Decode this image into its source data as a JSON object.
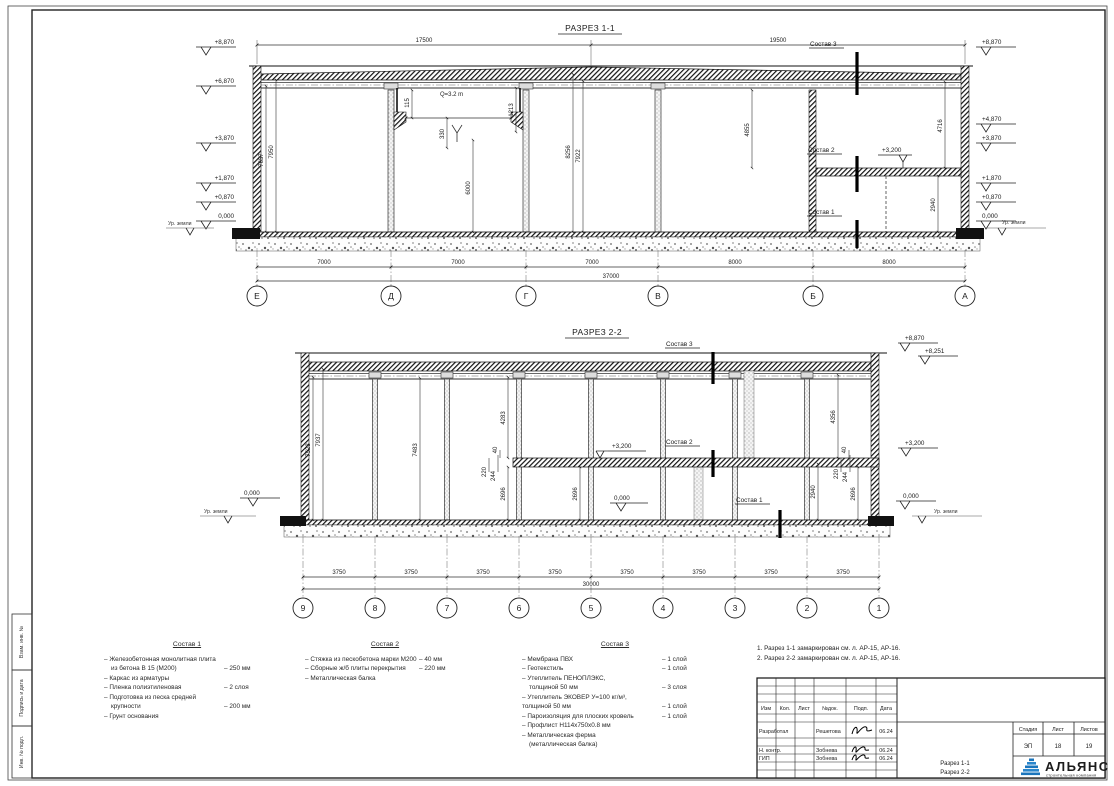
{
  "frame": {
    "labels": [
      "Взам. инв. №",
      "Подпись и дата",
      "Инв. № подл."
    ]
  },
  "s1": {
    "title": "РАЗРЕЗ 1-1",
    "dim_top_left": "17500",
    "dim_top_right": "19500",
    "elev_left": [
      "+8,870",
      "+6,870",
      "+3,870",
      "+1,870",
      "+0,870",
      "0,000"
    ],
    "elev_right": [
      "+8,870",
      "+4,870",
      "+3,870",
      "+1,870",
      "+0,870",
      "0,000"
    ],
    "ground_left": "Ур. земли",
    "ground_right": "Ур. земли",
    "crane": "Q=3.2 m",
    "v115": "115",
    "v1213": "1213",
    "v330": "330",
    "v6000": "6000",
    "v7657": "7657",
    "v7950": "7950",
    "v8256": "8256",
    "v7922": "7922",
    "v4855": "4855",
    "v4716": "4716",
    "v2940": "2940",
    "mezz_elev": "+3,200",
    "sostav1": "Состав 1",
    "sostav2": "Состав 2",
    "sostav3": "Состав 3",
    "dims": [
      "7000",
      "7000",
      "7000",
      "8000",
      "8000"
    ],
    "total": "37000",
    "axes": [
      "Е",
      "Д",
      "Г",
      "В",
      "Б",
      "А"
    ]
  },
  "s2": {
    "title": "РАЗРЕЗ 2-2",
    "elev_top": "+8,870",
    "elev_top2": "+8,251",
    "elev_mezz_in": "+3,200",
    "elev_mezz_out": "+3,200",
    "zero_left": "0,000",
    "zero_in": "0,000",
    "zero_right": "0,000",
    "ground_left": "Ур. земли",
    "ground_right": "Ур. земли",
    "v7523": "7523",
    "v7937": "7937",
    "v7483": "7483",
    "v4283": "4283",
    "v40l": "40",
    "v220l": "220",
    "v244l": "244",
    "v2696a": "2696",
    "v2696b": "2696",
    "v4356": "4356",
    "v40r": "40",
    "v220r": "220",
    "v244r": "244",
    "v2940": "2940",
    "v2696r": "2696",
    "sostav1": "Состав 1",
    "sostav2": "Состав 2",
    "sostav3": "Состав 3",
    "dims": [
      "3750",
      "3750",
      "3750",
      "3750",
      "3750",
      "3750",
      "3750",
      "3750"
    ],
    "total": "30000",
    "axes": [
      "9",
      "8",
      "7",
      "6",
      "5",
      "4",
      "3",
      "2",
      "1"
    ]
  },
  "comp1": {
    "title": "Состав 1",
    "rows": [
      {
        "t": "– Железобетонная  монолитная плита",
        "v": ""
      },
      {
        "t": "из бетона В 15 (М200)",
        "v": "– 250 мм"
      },
      {
        "t": "– Каркас из арматуры",
        "v": ""
      },
      {
        "t": "– Пленка полиэтиленовая",
        "v": "– 2 слоя"
      },
      {
        "t": "– Подготовка из песка средней",
        "v": ""
      },
      {
        "t": "крупности",
        "v": "– 200 мм"
      },
      {
        "t": "– Грунт основания",
        "v": ""
      }
    ]
  },
  "comp2": {
    "title": "Состав 2",
    "rows": [
      {
        "t": "– Стяжка из пескобетона марки М200",
        "v": "– 40 мм"
      },
      {
        "t": "– Сборные ж/б плиты перекрытия",
        "v": "– 220 мм"
      },
      {
        "t": "– Металлическая балка",
        "v": ""
      }
    ]
  },
  "comp3": {
    "title": "Состав 3",
    "rows": [
      {
        "t": "– Мембрана ПВХ",
        "v": "– 1 слой"
      },
      {
        "t": "– Геотекстиль",
        "v": "– 1 слой"
      },
      {
        "t": "– Утеплитель ПЕНОПЛЭКС,",
        "v": ""
      },
      {
        "t": "толщиной 50 мм",
        "v": "– 3 слоя"
      },
      {
        "t": "– Утеплитель ЭКОВЕР У=100 кг/м³,",
        "v": ""
      },
      {
        "t": "толщиной 50 мм",
        "v": "– 1 слой"
      },
      {
        "t": "– Пароизоляция для плоских кровель",
        "v": "– 1 слой"
      },
      {
        "t": "– Профлист  Н114х750х0.8 мм",
        "v": ""
      },
      {
        "t": "– Металлическая ферма",
        "v": ""
      },
      {
        "t": "(металлическая балка)",
        "v": ""
      }
    ]
  },
  "notes": [
    "1. Разрез 1-1 замаркирован см. л. АР-15, АР-16.",
    "2. Разрез 2-2 замаркирован см. л. АР-15, АР-16."
  ],
  "tb": {
    "cols": [
      "Изм",
      "Кол.",
      "Лист",
      "№док.",
      "Подп.",
      "Дата"
    ],
    "r1_role": "Разработал",
    "r1_name": "Решетова",
    "r1_date": "06.24",
    "r2_role": "Н. контр.",
    "r2_name": "Зобнева",
    "r2_date": "06.24",
    "r3_role": "ГИП",
    "r3_name": "Зобнева",
    "r3_date": "06.24",
    "title1": "Разрез 1-1",
    "title2": "Разрез 2-2",
    "stage_label": "Стадия",
    "sheet_label": "Лист",
    "sheets_label": "Листов",
    "stage": "ЭП",
    "sheet": "18",
    "sheets": "19",
    "company": "АЛЬЯНС",
    "company_sub": "строительная компания",
    "brand": "#1b75bc"
  }
}
